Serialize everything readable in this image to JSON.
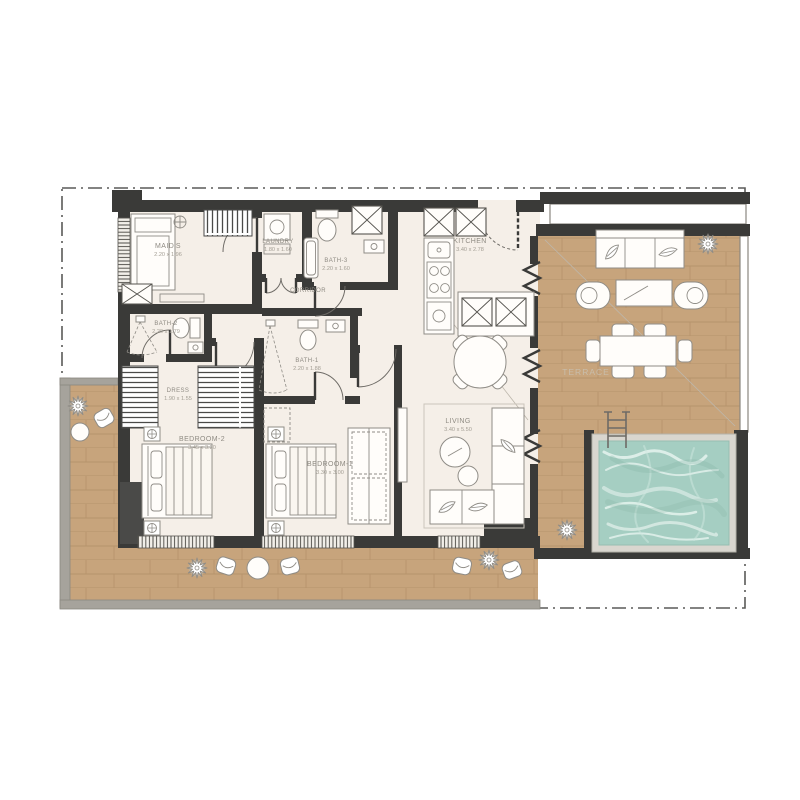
{
  "title": "apartment-floor-plan",
  "colors": {
    "bg": "#ffffff",
    "wall": "#3a3a38",
    "floor": "#f5efe8",
    "wood": "#c7a47c",
    "woodLine": "#b08d66",
    "poolWater": "#a5cec2",
    "poolTile": "#d9d6cf",
    "outerWall": "#a6a39c",
    "line": "#8f8c86",
    "text": "#8f8b83"
  },
  "rooms": [
    {
      "name": "MAID'S",
      "dims": "2.20 x 1.96"
    },
    {
      "name": "LAUNDRY",
      "dims": "1.80 x 1.60"
    },
    {
      "name": "BATH-3",
      "dims": "2.20 x 1.60"
    },
    {
      "name": "KITCHEN",
      "dims": "3.40 x 2.78"
    },
    {
      "name": "CORRIDOR",
      "dims": ""
    },
    {
      "name": "BATH-2",
      "dims": "2.20 x 1.79"
    },
    {
      "name": "BATH-1",
      "dims": "2.20 x 1.88"
    },
    {
      "name": "DRESS",
      "dims": "1.90 x 1.55"
    },
    {
      "name": "BEDROOM-2",
      "dims": "3.45 x 3.20"
    },
    {
      "name": "BEDROOM-1",
      "dims": "3.30 x 3.00"
    },
    {
      "name": "LIVING",
      "dims": "3.40 x 5.50"
    },
    {
      "name": "TERRACE",
      "dims": ""
    }
  ]
}
